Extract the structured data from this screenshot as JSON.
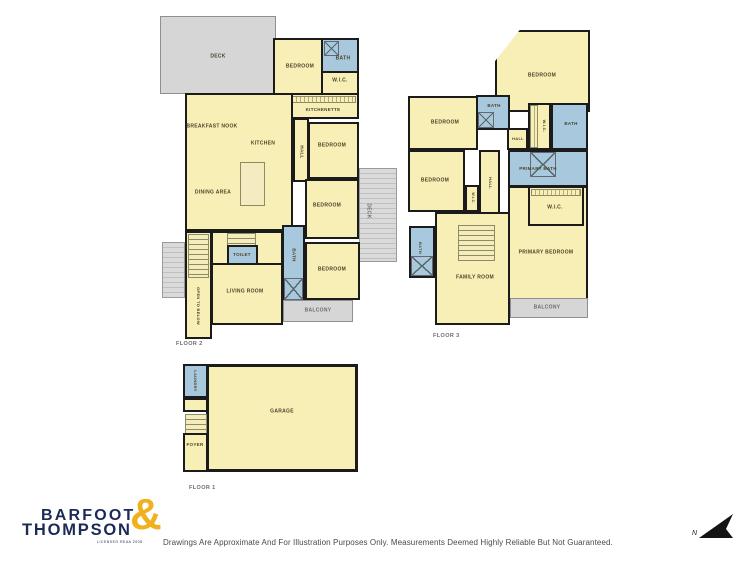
{
  "branding": {
    "line1": "BARFOOT",
    "line2": "THOMPSON",
    "ampersand": "&",
    "tagline": "LICENSED REAA 2008"
  },
  "disclaimer": "Drawings Are Approximate And For Illustration Purposes Only. Measurements Deemed Highly Reliable But Not Guaranteed.",
  "north": {
    "label": "N"
  },
  "colors": {
    "room_fill": "#f8efb7",
    "wet_area_fill": "#a8c8dd",
    "deck_fill": "#d6d6d6",
    "wall": "#1b1b1b",
    "logo_navy": "#1b2a56",
    "logo_gold": "#efb11d"
  },
  "floor2": {
    "label": "FLOOR 2",
    "rooms": {
      "deck_nw": "DECK",
      "bedroom_n": "BEDROOM",
      "bath_n": "BATH",
      "wic_n": "W.I.C.",
      "kitchenette": "KITCHENETTE",
      "breakfast_nook": "BREAKFAST NOOK",
      "kitchen": "KITCHEN",
      "dining": "DINING AREA",
      "hall_mid": "HALL",
      "bedroom_e1": "BEDROOM",
      "bedroom_e2": "BEDROOM",
      "deck_e": "DECK",
      "hall_stairs": "HALL",
      "toilet": "TOILET",
      "bath_s": "BATH",
      "open_below": "OPEN TO BELOW",
      "living": "LIVING ROOM",
      "bedroom_e3": "BEDROOM",
      "balcony": "BALCONY"
    }
  },
  "floor3": {
    "label": "FLOOR 3",
    "rooms": {
      "bedroom_ne": "BEDROOM",
      "bedroom_w": "BEDROOM",
      "bath_c": "BATH",
      "wic_n": "W.I.C.",
      "bath_e": "BATH",
      "hall_n": "HALL",
      "primary_bath": "PRIMARY BATH",
      "wic_room": "W.I.C.",
      "bedroom_sw": "BEDROOM",
      "wic_sw": "W.I.C.",
      "hall_s": "HALL",
      "bath_w": "BATH",
      "family": "FAMILY ROOM",
      "primary_bedroom": "PRIMARY BEDROOM",
      "balcony": "BALCONY"
    }
  },
  "floor1": {
    "label": "FLOOR 1",
    "rooms": {
      "laundry": "LAUNDRY",
      "foyer": "FOYER",
      "garage": "GARAGE"
    }
  }
}
